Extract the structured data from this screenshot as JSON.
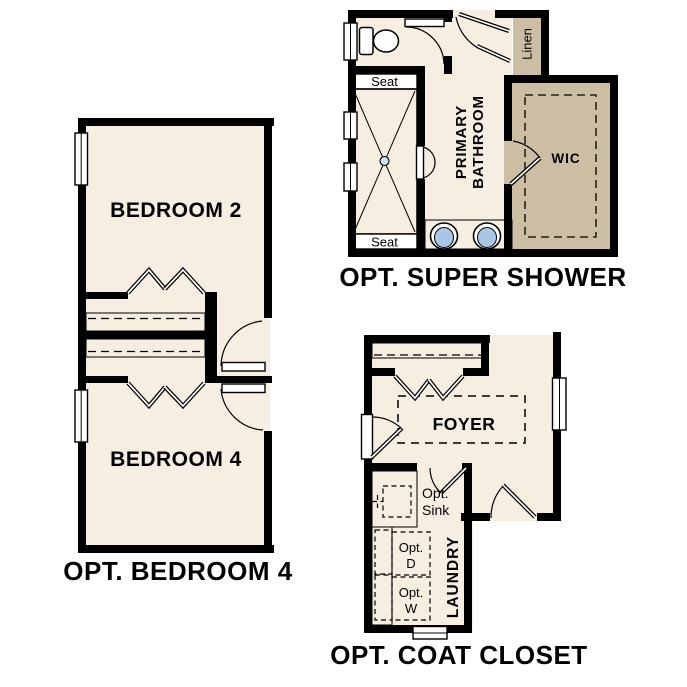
{
  "colors": {
    "background": "#ffffff",
    "floor": "#f5eee1",
    "wall": "#000000",
    "shelf_tan": "#cbbea3",
    "fixture_blue": "#a9c6e7",
    "appliance_gray": "#dbdbdb",
    "text": "#000000"
  },
  "plans": {
    "super_shower": {
      "caption": "OPT. SUPER SHOWER",
      "labels": {
        "primary_bathroom_lines": [
          "PRIMARY",
          "BATHROOM"
        ],
        "wic": "WIC",
        "linen": "Linen",
        "seat_top": "Seat",
        "seat_bottom": "Seat"
      }
    },
    "bedroom4": {
      "caption": "OPT. BEDROOM 4",
      "labels": {
        "bedroom2": "BEDROOM 2",
        "bedroom4": "BEDROOM 4"
      }
    },
    "coat_closet": {
      "caption": "OPT. COAT CLOSET",
      "labels": {
        "foyer": "FOYER",
        "laundry": "LAUNDRY",
        "opt_sink_lines": [
          "Opt.",
          "Sink"
        ],
        "opt_dryer_lines": [
          "Opt.",
          "D"
        ],
        "opt_washer_lines": [
          "Opt.",
          "W"
        ]
      }
    }
  }
}
